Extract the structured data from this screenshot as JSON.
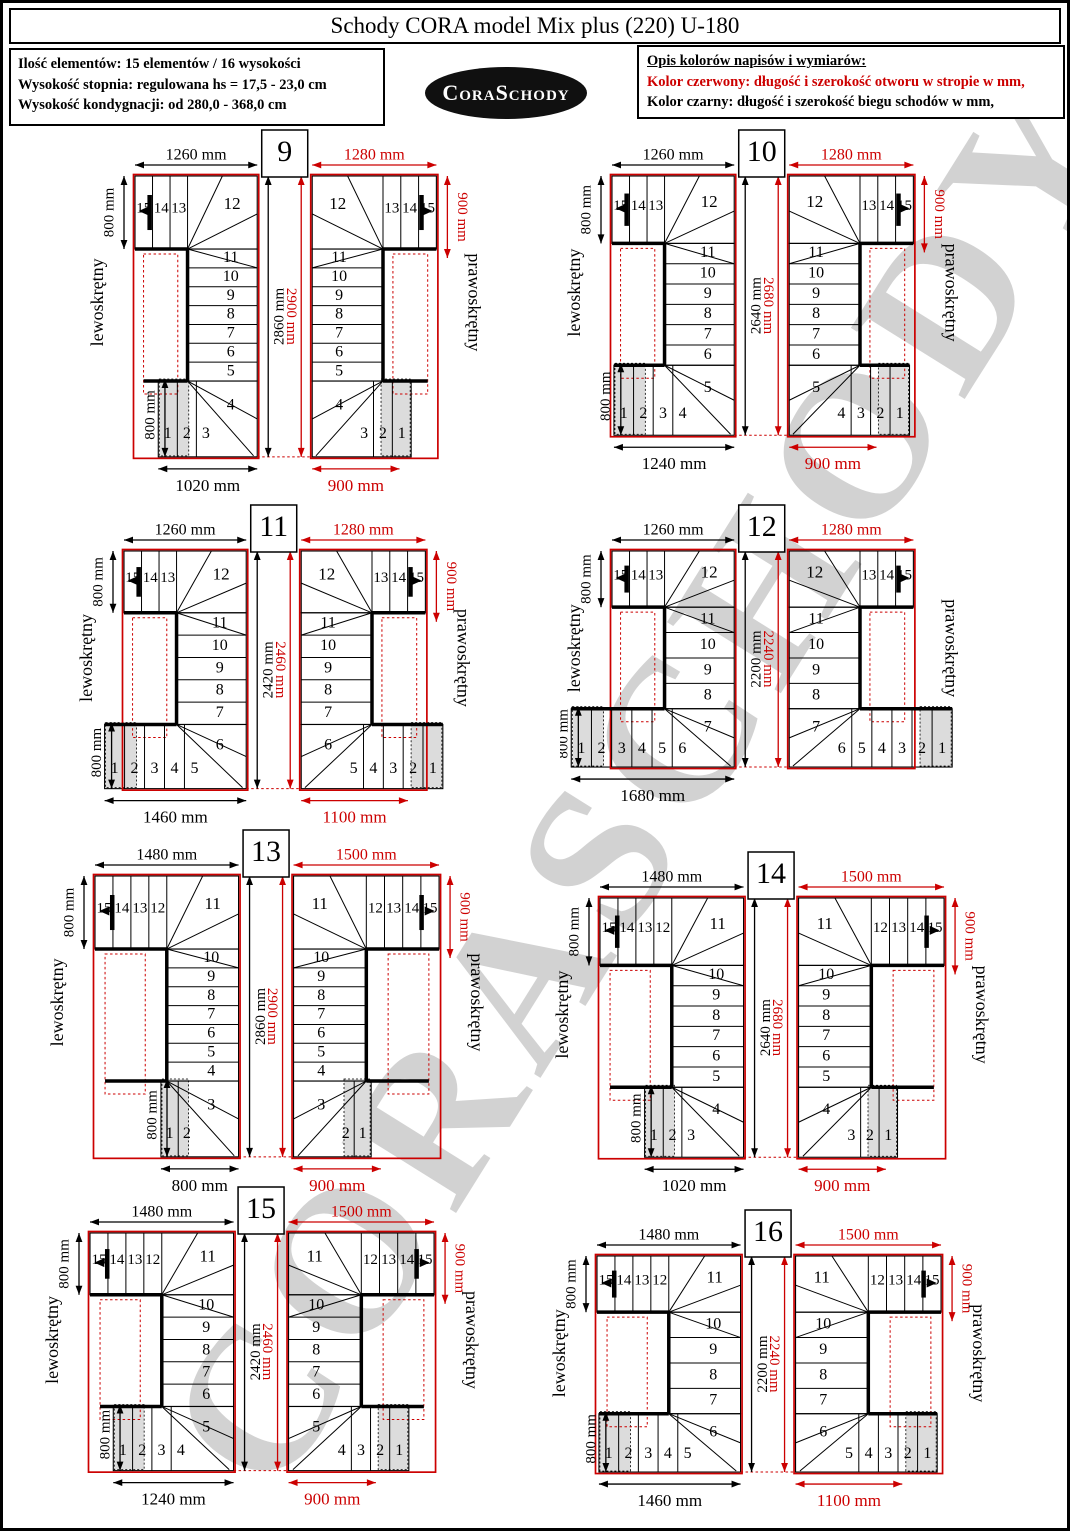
{
  "page": {
    "title": "Schody CORA model Mix plus (220) U-180",
    "info_box": {
      "line1": "Ilość elementów: 15 elementów / 16 wysokości",
      "line2": "Wysokość stopnia: regulowana  hs = 17,5 - 23,0 cm",
      "line3": "Wysokość kondygnacji: od 280,0 - 368,0 cm"
    },
    "logo_text": "CoraSchody",
    "legend": {
      "heading": "Opis kolorów napisów i wymiarów:",
      "red_label": "Kolor czerwony:",
      "red_text": " długość i szerokość otworu w stropie w mm,",
      "black_label": "Kolor czarny:",
      "black_text": " długość i szerokość biegu schodów w mm,"
    },
    "watermark": "CORASCHODY"
  },
  "colors": {
    "red": "#cc0000",
    "black": "#000000",
    "gray_fill": "#dcdcdc"
  },
  "labels": {
    "left_variant": "lewoskrętny",
    "right_variant": "prawoskrętny"
  },
  "diagrams": [
    {
      "number": "9",
      "left": {
        "top": "1260 mm",
        "side_top": "800 mm",
        "height": "2860 mm",
        "side_bottom": "800 mm",
        "bottom": "1020 mm",
        "top_cols": [
          15,
          14,
          13
        ],
        "top_fan": 12,
        "rows": [
          11,
          10,
          9,
          8,
          7,
          6,
          5
        ],
        "bottom_fan": 4,
        "bottom_cols": [
          1,
          2,
          3
        ]
      },
      "right": {
        "top": "1280 mm",
        "side_top": "900 mm",
        "height": "2900 mm",
        "side_bottom": null,
        "bottom": "900 mm",
        "top_cols": [
          15,
          14,
          13
        ],
        "top_fan": 12,
        "rows": [
          11,
          10,
          9,
          8,
          7,
          6,
          5
        ],
        "bottom_fan": 4,
        "bottom_cols": [
          1,
          2,
          3
        ]
      }
    },
    {
      "number": "10",
      "left": {
        "top": "1260 mm",
        "side_top": "800 mm",
        "height": "2640 mm",
        "side_bottom": "800 mm",
        "bottom": "1240 mm",
        "top_cols": [
          15,
          14,
          13
        ],
        "top_fan": 12,
        "rows": [
          11,
          10,
          9,
          8,
          7,
          6
        ],
        "bottom_fan": 5,
        "bottom_cols": [
          1,
          2,
          3,
          4
        ]
      },
      "right": {
        "top": "1280 mm",
        "side_top": "900 mm",
        "height": "2680 mm",
        "side_bottom": null,
        "bottom": "900 mm",
        "top_cols": [
          15,
          14,
          13
        ],
        "top_fan": 12,
        "rows": [
          11,
          10,
          9,
          8,
          7,
          6
        ],
        "bottom_fan": 5,
        "bottom_cols": [
          1,
          2,
          3,
          4
        ]
      }
    },
    {
      "number": "11",
      "left": {
        "top": "1260 mm",
        "side_top": "800 mm",
        "height": "2420 mm",
        "side_bottom": "800 mm",
        "bottom": "1460 mm",
        "top_cols": [
          15,
          14,
          13
        ],
        "top_fan": 12,
        "rows": [
          11,
          10,
          9,
          8,
          7
        ],
        "bottom_fan": 6,
        "bottom_cols": [
          1,
          2,
          3,
          4,
          5
        ]
      },
      "right": {
        "top": "1280 mm",
        "side_top": "900 mm",
        "height": "2460 mm",
        "side_bottom": null,
        "bottom": "1100 mm",
        "top_cols": [
          15,
          14,
          13
        ],
        "top_fan": 12,
        "rows": [
          11,
          10,
          9,
          8,
          7
        ],
        "bottom_fan": 6,
        "bottom_cols": [
          1,
          2,
          3,
          4,
          5
        ]
      }
    },
    {
      "number": "12",
      "left": {
        "top": "1260 mm",
        "side_top": "800 mm",
        "height": "2200 mm",
        "side_bottom": "800 mm",
        "bottom": "1680 mm",
        "top_cols": [
          15,
          14,
          13
        ],
        "top_fan": 12,
        "rows": [
          11,
          10,
          9,
          8
        ],
        "bottom_fan": 7,
        "bottom_cols": [
          1,
          2,
          3,
          4,
          5,
          6
        ]
      },
      "right": {
        "top": "1280 mm",
        "side_top": null,
        "height": "2240 mm",
        "side_bottom": null,
        "bottom": null,
        "top_cols": [
          15,
          14,
          13
        ],
        "top_fan": 12,
        "rows": [
          11,
          10,
          9,
          8
        ],
        "bottom_fan": 7,
        "bottom_cols": [
          1,
          2,
          3,
          4,
          5,
          6
        ]
      }
    },
    {
      "number": "13",
      "left": {
        "top": "1480 mm",
        "side_top": "800 mm",
        "height": "2860 mm",
        "side_bottom": "800 mm",
        "bottom": "800 mm",
        "top_cols": [
          15,
          14,
          13,
          12
        ],
        "top_fan": 11,
        "rows": [
          10,
          9,
          8,
          7,
          6,
          5,
          4
        ],
        "bottom_fan": 3,
        "bottom_cols": [
          1,
          2
        ]
      },
      "right": {
        "top": "1500 mm",
        "side_top": "900 mm",
        "height": "2900 mm",
        "side_bottom": null,
        "bottom": "900 mm",
        "top_cols": [
          15,
          14,
          13,
          12
        ],
        "top_fan": 11,
        "rows": [
          10,
          9,
          8,
          7,
          6,
          5,
          4
        ],
        "bottom_fan": 3,
        "bottom_cols": [
          1,
          2
        ]
      }
    },
    {
      "number": "14",
      "left": {
        "top": "1480 mm",
        "side_top": "800 mm",
        "height": "2640 mm",
        "side_bottom": "800 mm",
        "bottom": "1020 mm",
        "top_cols": [
          15,
          14,
          13,
          12
        ],
        "top_fan": 11,
        "rows": [
          10,
          9,
          8,
          7,
          6,
          5
        ],
        "bottom_fan": 4,
        "bottom_cols": [
          1,
          2,
          3
        ]
      },
      "right": {
        "top": "1500 mm",
        "side_top": "900 mm",
        "height": "2680 mm",
        "side_bottom": null,
        "bottom": "900 mm",
        "top_cols": [
          15,
          14,
          13,
          12
        ],
        "top_fan": 11,
        "rows": [
          10,
          9,
          8,
          7,
          6,
          5
        ],
        "bottom_fan": 4,
        "bottom_cols": [
          1,
          2,
          3
        ]
      }
    },
    {
      "number": "15",
      "left": {
        "top": "1480 mm",
        "side_top": "800 mm",
        "height": "2420 mm",
        "side_bottom": "800 mm",
        "bottom": "1240 mm",
        "top_cols": [
          15,
          14,
          13,
          12
        ],
        "top_fan": 11,
        "rows": [
          10,
          9,
          8,
          7,
          6
        ],
        "bottom_fan": 5,
        "bottom_cols": [
          1,
          2,
          3,
          4
        ]
      },
      "right": {
        "top": "1500 mm",
        "side_top": "900 mm",
        "height": "2460 mm",
        "side_bottom": null,
        "bottom": "900 mm",
        "top_cols": [
          15,
          14,
          13,
          12
        ],
        "top_fan": 11,
        "rows": [
          10,
          9,
          8,
          7,
          6
        ],
        "bottom_fan": 5,
        "bottom_cols": [
          1,
          2,
          3,
          4
        ]
      }
    },
    {
      "number": "16",
      "left": {
        "top": "1480 mm",
        "side_top": "800 mm",
        "height": "2200 mm",
        "side_bottom": "800 mm",
        "bottom": "1460 mm",
        "top_cols": [
          15,
          14,
          13,
          12
        ],
        "top_fan": 11,
        "rows": [
          10,
          9,
          8,
          7
        ],
        "bottom_fan": 6,
        "bottom_cols": [
          1,
          2,
          3,
          4,
          5
        ]
      },
      "right": {
        "top": "1500 mm",
        "side_top": "900 mm",
        "height": "2240 mm",
        "side_bottom": null,
        "bottom": "1100 mm",
        "top_cols": [
          15,
          14,
          13,
          12
        ],
        "top_fan": 11,
        "rows": [
          10,
          9,
          8,
          7
        ],
        "bottom_fan": 6,
        "bottom_cols": [
          1,
          2,
          3,
          4,
          5
        ]
      }
    }
  ]
}
